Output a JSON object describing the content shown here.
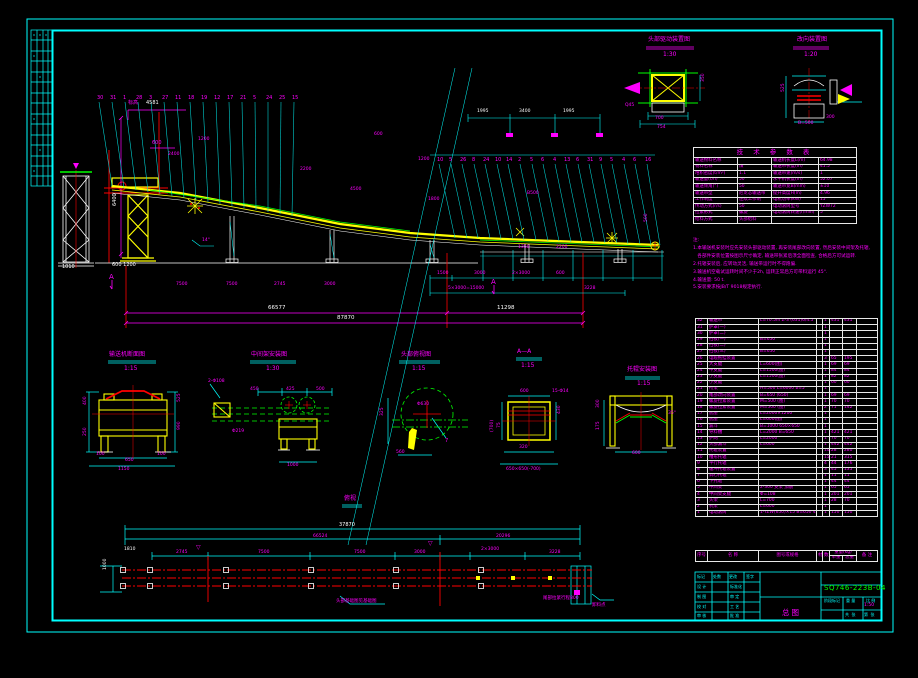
{
  "doc": {
    "drawing_no": "SQ746-223B-04",
    "view_title": "总图",
    "scale": "1:50"
  },
  "param_table": {
    "title": "技 术 参 数 表",
    "rows": [
      [
        "输送物料名称",
        "",
        "输送机长度L(m)",
        "64.98"
      ],
      [
        "物料名称",
        "煤",
        "输送带长度(m)",
        "41.5"
      ],
      [
        "堆积密度(t/m³)",
        "1.1",
        "输送带速(m/s)",
        "1"
      ],
      [
        "输送量(t/h)",
        "50",
        "水平机长度(m)",
        "52.07"
      ],
      [
        "输送倾角(°)",
        "50",
        "输送带宽B(mm)",
        "±10"
      ],
      [
        "输送带型",
        "尼龙芯输送带",
        "提升高度H(m)",
        "4.96"
      ],
      [
        "工作制度",
        "连续工作制",
        "电机功率(kW)",
        "15"
      ],
      [
        "传动方式(r/s)",
        "50",
        "电动滚筒型号",
        "YZW72"
      ],
      [
        "拉紧形式",
        "螺旋",
        "电动滚筒转速(r/min)",
        "5"
      ],
      [
        "给料方式",
        "头部给料",
        "",
        ""
      ]
    ]
  },
  "notes": [
    "注:",
    "1.本输送机安装时应先安装头部驱动装置, 再安装尾部改向装置, 然后安装中间架及托辊,",
    "   各部件安装位置按图示尺寸确定, 输送带张紧后须全面检查, 合格后方可试运转.",
    "2.托辊安装后, 应转动灵活, 输送带运行时不得跑偏.",
    "3.输送机空载试运转时间不少于2h, 运转正常后方可带料运行 45°.",
    "4.输送量: 50 t.",
    "5.安装要求按JB/T 9018规定执行."
  ],
  "bom": {
    "headers": {
      "no": "序号",
      "name": "名  称",
      "spec": "图号或规格",
      "mat": "材料",
      "qty": "数量",
      "weight": "重量(kg)",
      "unit": "单重",
      "total": "总重",
      "remark": "备 注"
    },
    "rows": [
      [
        "32",
        "输送带",
        "L=70.5m Z-3 (631)6/4.5",
        "",
        "1",
        "431",
        "431",
        ""
      ],
      [
        "31",
        "护罩(一)",
        "",
        "",
        "1",
        "",
        "",
        ""
      ],
      [
        "30",
        "护罩(二)",
        "",
        "",
        "1",
        "",
        "",
        ""
      ],
      [
        "29",
        "挡板(一)",
        "B=650",
        "",
        "1",
        "",
        "",
        ""
      ],
      [
        "28",
        "挡板(二)",
        "",
        "",
        "1",
        "",
        "",
        ""
      ],
      [
        "27",
        "挡板(三)",
        "B=650",
        "",
        "1",
        "",
        "",
        ""
      ],
      [
        "26",
        "电缆拖挂装置",
        "",
        "",
        "3",
        "65",
        "195",
        ""
      ],
      [
        "25",
        "大支腿",
        "L=600(图)",
        "",
        "1",
        "69",
        "69",
        ""
      ],
      [
        "24",
        "中支腿",
        "L=1500(图)",
        "",
        "1",
        "84",
        "84",
        ""
      ],
      [
        "23",
        "小支腿",
        "L=1500(图)",
        "",
        "1",
        "82",
        "82",
        ""
      ],
      [
        "22",
        "小支腿",
        "",
        "",
        "1",
        "60",
        "60",
        ""
      ],
      [
        "21",
        "桁架",
        "H=500 L=6000 b=5°",
        "",
        "1",
        "",
        "",
        ""
      ],
      [
        "20",
        "尾部改向装置",
        "B=650 (650)",
        "",
        "1",
        "69",
        "69",
        ""
      ],
      [
        "19",
        "螺旋拉紧装置",
        "M=500 (图)",
        "",
        "1",
        "70",
        "70",
        ""
      ],
      [
        "18",
        "螺旋拉紧装置",
        "M=500 (图)",
        "",
        "2",
        "71",
        "142",
        ""
      ],
      [
        "17",
        "底座",
        "L=2000×1200",
        "",
        "1",
        "",
        "",
        ""
      ],
      [
        "16",
        "底座",
        "L=600(图)",
        "",
        "1",
        "",
        "",
        ""
      ],
      [
        "15",
        "漏斗",
        "B=1000 650×650",
        "",
        "1",
        "",
        "",
        ""
      ],
      [
        "14",
        "导料槽",
        "L=2000 B=650",
        "",
        "1",
        "421",
        "421",
        ""
      ],
      [
        "13",
        "护网",
        "L=2000",
        "",
        "1",
        "70",
        "70",
        ""
      ],
      [
        "12",
        "头部漏斗",
        "L=600",
        "",
        "1",
        "442",
        "442",
        ""
      ],
      [
        "11",
        "托辊装置",
        "",
        "",
        "10",
        "28",
        "280",
        ""
      ],
      [
        "10",
        "槽形托辊",
        "",
        "",
        "15",
        "21",
        "315",
        ""
      ],
      [
        "9",
        "平行托辊",
        "",
        "",
        "4",
        "44",
        "176",
        ""
      ],
      [
        "8",
        "缓冲托辊装置",
        "",
        "",
        "3",
        "45",
        "135",
        ""
      ],
      [
        "7",
        "调心托辊",
        "",
        "",
        "1",
        "11",
        "11",
        ""
      ],
      [
        "6",
        "下托辊",
        "",
        "",
        "1",
        "44",
        "44",
        ""
      ],
      [
        "5",
        "中间架",
        "2-300 支架 加筋",
        "",
        "1",
        "65",
        "65",
        ""
      ],
      [
        "4",
        "中间架支腿",
        "Φ=108",
        "",
        "1",
        "201",
        "201",
        ""
      ],
      [
        "3",
        "头架",
        "L=700",
        "",
        "1",
        "28",
        "70",
        ""
      ],
      [
        "2",
        "机架",
        "L=600",
        "",
        "1",
        "",
        "",
        ""
      ],
      [
        "1",
        "电动滚筒",
        "1-YZW(650)×15 B=650 45r/min",
        "",
        "1",
        "150",
        "150",
        ""
      ]
    ]
  },
  "labels": [
    {
      "x": 648,
      "y": 37,
      "t": "头部驱动装置图",
      "s": 6
    },
    {
      "x": 663,
      "y": 52,
      "t": "1:30",
      "s": 6
    },
    {
      "x": 797,
      "y": 37,
      "t": "改向装置图",
      "s": 6
    },
    {
      "x": 804,
      "y": 52,
      "t": "1:20",
      "s": 6
    },
    {
      "x": 109,
      "y": 352,
      "t": "输送机断面图",
      "s": 6
    },
    {
      "x": 124,
      "y": 366,
      "t": "1:15",
      "s": 6
    },
    {
      "x": 251,
      "y": 352,
      "t": "中间架安装图",
      "s": 6
    },
    {
      "x": 266,
      "y": 366,
      "t": "1:30",
      "s": 6
    },
    {
      "x": 401,
      "y": 352,
      "t": "头部俯视图",
      "s": 6
    },
    {
      "x": 412,
      "y": 366,
      "t": "1:15",
      "s": 6
    },
    {
      "x": 517,
      "y": 349,
      "t": "A—A",
      "s": 6
    },
    {
      "x": 521,
      "y": 363,
      "t": "1:15",
      "s": 6
    },
    {
      "x": 627,
      "y": 367,
      "t": "托辊安装图",
      "s": 6
    },
    {
      "x": 637,
      "y": 381,
      "t": "1:15",
      "s": 6
    },
    {
      "x": 344,
      "y": 496,
      "t": "俯视",
      "s": 6
    },
    {
      "x": 268,
      "y": 306,
      "t": "66577",
      "c": "#fff",
      "s": 5.5
    },
    {
      "x": 497,
      "y": 306,
      "t": "11298",
      "c": "#fff",
      "s": 5.5
    },
    {
      "x": 337,
      "y": 316,
      "t": "87870",
      "c": "#fff",
      "s": 5.5
    },
    {
      "x": 128,
      "y": 101,
      "t": "标高"
    },
    {
      "x": 146,
      "y": 101,
      "t": "4581",
      "c": "#fff"
    },
    {
      "x": 113,
      "y": 206,
      "t": "6400",
      "c": "#fff",
      "r": -90
    },
    {
      "x": 112,
      "y": 263,
      "t": "600 1200",
      "c": "#fff"
    },
    {
      "x": 62,
      "y": 265,
      "t": "1010",
      "c": "#fff"
    },
    {
      "x": 152,
      "y": 141,
      "t": "600"
    },
    {
      "x": 109,
      "y": 274,
      "t": "A",
      "s": 7
    },
    {
      "x": 491,
      "y": 279,
      "t": "A",
      "s": 7
    },
    {
      "x": 477,
      "y": 110,
      "t": "1995",
      "c": "#fff",
      "s": 4.5
    },
    {
      "x": 519,
      "y": 110,
      "t": "3400",
      "c": "#fff",
      "s": 4.5
    },
    {
      "x": 563,
      "y": 110,
      "t": "1995",
      "c": "#fff",
      "s": 4.5
    },
    {
      "x": 176,
      "y": 283,
      "t": "7500",
      "s": 4.5
    },
    {
      "x": 226,
      "y": 283,
      "t": "7500",
      "s": 4.5
    },
    {
      "x": 274,
      "y": 283,
      "t": "2745",
      "s": 4.5
    },
    {
      "x": 324,
      "y": 283,
      "t": "3000",
      "s": 4.5
    },
    {
      "x": 437,
      "y": 272,
      "t": "1500",
      "s": 4.5
    },
    {
      "x": 474,
      "y": 272,
      "t": "3000",
      "s": 4.5
    },
    {
      "x": 512,
      "y": 272,
      "t": "2×3000",
      "s": 4.5
    },
    {
      "x": 556,
      "y": 272,
      "t": "600",
      "s": 4.5
    },
    {
      "x": 448,
      "y": 287,
      "t": "5×3000=15000",
      "s": 4.5
    },
    {
      "x": 584,
      "y": 287,
      "t": "3228",
      "s": 4.5
    },
    {
      "x": 518,
      "y": 246,
      "t": "1350",
      "s": 4.5
    },
    {
      "x": 556,
      "y": 246,
      "t": "2200",
      "s": 4.5
    },
    {
      "x": 350,
      "y": 188,
      "t": "4500",
      "s": 4.5
    },
    {
      "x": 300,
      "y": 168,
      "t": "2200",
      "s": 4.5
    },
    {
      "x": 428,
      "y": 198,
      "t": "1800",
      "s": 4.5
    },
    {
      "x": 527,
      "y": 192,
      "t": "B500",
      "s": 4.5
    },
    {
      "x": 374,
      "y": 133,
      "t": "600",
      "s": 4.5
    },
    {
      "x": 418,
      "y": 158,
      "t": "1200",
      "s": 4.5
    },
    {
      "x": 168,
      "y": 153,
      "t": "2400",
      "s": 4.5
    },
    {
      "x": 198,
      "y": 138,
      "t": "1200",
      "s": 4.5
    },
    {
      "x": 202,
      "y": 239,
      "t": "14°",
      "s": 4.5
    },
    {
      "x": 645,
      "y": 222,
      "t": "500",
      "s": 4.5,
      "r": -90
    },
    {
      "x": 339,
      "y": 523,
      "t": "37870",
      "c": "#fff",
      "s": 5
    },
    {
      "x": 313,
      "y": 535,
      "t": "66524",
      "s": 4.5
    },
    {
      "x": 496,
      "y": 535,
      "t": "20296",
      "s": 4.5
    },
    {
      "x": 124,
      "y": 548,
      "t": "1810",
      "c": "#fff",
      "s": 4.5
    },
    {
      "x": 104,
      "y": 570,
      "t": "1000",
      "c": "#fff",
      "s": 4.5,
      "r": -90
    },
    {
      "x": 176,
      "y": 551,
      "t": "2745",
      "s": 4.5
    },
    {
      "x": 258,
      "y": 551,
      "t": "7500",
      "s": 4.5
    },
    {
      "x": 354,
      "y": 551,
      "t": "7500",
      "s": 4.5
    },
    {
      "x": 414,
      "y": 551,
      "t": "3000",
      "s": 4.5
    },
    {
      "x": 481,
      "y": 548,
      "t": "2×3000",
      "s": 4.5
    },
    {
      "x": 549,
      "y": 551,
      "t": "3228",
      "s": 4.5
    },
    {
      "x": 196,
      "y": 545,
      "t": "▽",
      "s": 6
    },
    {
      "x": 428,
      "y": 541,
      "t": "▽",
      "s": 6
    },
    {
      "x": 336,
      "y": 600,
      "t": "头部基础图见基础图",
      "s": 4.5
    },
    {
      "x": 543,
      "y": 597,
      "t": "尾部拉紧行程800",
      "s": 4.5
    },
    {
      "x": 592,
      "y": 604,
      "t": "卸料点",
      "s": 4.5
    },
    {
      "x": 125,
      "y": 459,
      "t": "650",
      "s": 4.5
    },
    {
      "x": 118,
      "y": 468,
      "t": "1150",
      "s": 4.5
    },
    {
      "x": 84,
      "y": 405,
      "t": "400",
      "s": 4.5,
      "r": -90
    },
    {
      "x": 84,
      "y": 436,
      "t": "250",
      "s": 4.5,
      "r": -90
    },
    {
      "x": 178,
      "y": 402,
      "t": "525",
      "s": 4.5,
      "r": -90
    },
    {
      "x": 178,
      "y": 430,
      "t": "990",
      "s": 4.5,
      "r": -90
    },
    {
      "x": 96,
      "y": 453,
      "t": "100",
      "s": 4.5
    },
    {
      "x": 157,
      "y": 453,
      "t": "100",
      "s": 4.5
    },
    {
      "x": 250,
      "y": 388,
      "t": "450",
      "s": 4.5
    },
    {
      "x": 286,
      "y": 388,
      "t": "425",
      "s": 4.5
    },
    {
      "x": 316,
      "y": 388,
      "t": "500",
      "s": 4.5
    },
    {
      "x": 287,
      "y": 464,
      "t": "1000",
      "s": 4.5
    },
    {
      "x": 232,
      "y": 430,
      "t": "Φ219",
      "s": 4.5
    },
    {
      "x": 208,
      "y": 380,
      "t": "2-Φ108",
      "s": 4.5
    },
    {
      "x": 417,
      "y": 403,
      "t": "Φ630",
      "s": 4.5
    },
    {
      "x": 396,
      "y": 451,
      "t": "560",
      "s": 4.5
    },
    {
      "x": 381,
      "y": 416,
      "t": "325",
      "s": 4.5,
      "r": -90
    },
    {
      "x": 445,
      "y": 439,
      "t": "7",
      "s": 5
    },
    {
      "x": 520,
      "y": 390,
      "t": "600",
      "s": 4.5
    },
    {
      "x": 552,
      "y": 390,
      "t": "15-Φ14",
      "s": 4.5
    },
    {
      "x": 558,
      "y": 414,
      "t": "430",
      "s": 4.5,
      "r": -90
    },
    {
      "x": 498,
      "y": 428,
      "t": "75",
      "s": 4.5,
      "r": -90
    },
    {
      "x": 519,
      "y": 446,
      "t": "320",
      "s": 4.5
    },
    {
      "x": 506,
      "y": 468,
      "t": "650×650(-700)",
      "s": 4.5
    },
    {
      "x": 491,
      "y": 432,
      "t": "(700)",
      "s": 4.5,
      "r": -90
    },
    {
      "x": 632,
      "y": 452,
      "t": "600",
      "s": 4.5
    },
    {
      "x": 597,
      "y": 408,
      "t": "300",
      "s": 4.5,
      "r": -90
    },
    {
      "x": 597,
      "y": 430,
      "t": "175",
      "s": 4.5,
      "r": -90
    },
    {
      "x": 668,
      "y": 412,
      "t": "35°",
      "s": 4.5
    },
    {
      "x": 655,
      "y": 117,
      "t": "700",
      "s": 4.5
    },
    {
      "x": 657,
      "y": 126,
      "t": "754",
      "s": 4.5
    },
    {
      "x": 625,
      "y": 104,
      "t": "Q45",
      "s": 4.5
    },
    {
      "x": 702,
      "y": 82,
      "t": "350",
      "s": 4.5,
      "r": -90
    },
    {
      "x": 782,
      "y": 92,
      "t": "525",
      "s": 4.5,
      "r": -90
    },
    {
      "x": 798,
      "y": 122,
      "t": "B=500",
      "s": 4.5
    },
    {
      "x": 826,
      "y": 116,
      "t": "300",
      "s": 4.5
    },
    {
      "x": 697,
      "y": 575,
      "t": "标记",
      "c": "#00ffff",
      "s": 4
    },
    {
      "x": 713,
      "y": 575,
      "t": "处数",
      "c": "#00ffff",
      "s": 4
    },
    {
      "x": 729,
      "y": 575,
      "t": "更改",
      "c": "#00ffff",
      "s": 4
    },
    {
      "x": 746,
      "y": 575,
      "t": "签字",
      "c": "#00ffff",
      "s": 4
    },
    {
      "x": 697,
      "y": 585,
      "t": "设 计",
      "c": "#00ffff",
      "s": 4
    },
    {
      "x": 697,
      "y": 595,
      "t": "制 图",
      "c": "#00ffff",
      "s": 4
    },
    {
      "x": 697,
      "y": 605,
      "t": "校 对",
      "c": "#00ffff",
      "s": 4
    },
    {
      "x": 697,
      "y": 614,
      "t": "审 核",
      "c": "#00ffff",
      "s": 4
    },
    {
      "x": 730,
      "y": 585,
      "t": "标准化",
      "c": "#00ffff",
      "s": 4
    },
    {
      "x": 730,
      "y": 595,
      "t": "审 定",
      "c": "#00ffff",
      "s": 4
    },
    {
      "x": 730,
      "y": 605,
      "t": "工 艺",
      "c": "#00ffff",
      "s": 4
    },
    {
      "x": 730,
      "y": 614,
      "t": "批 准",
      "c": "#00ffff",
      "s": 4
    },
    {
      "x": 824,
      "y": 599,
      "t": "阶段标记",
      "c": "#00ffff",
      "s": 4
    },
    {
      "x": 846,
      "y": 599,
      "t": "重 量",
      "c": "#00ffff",
      "s": 4
    },
    {
      "x": 866,
      "y": 599,
      "t": "比 例",
      "c": "#00ffff",
      "s": 4
    },
    {
      "x": 845,
      "y": 613,
      "t": "共  张",
      "c": "#00ffff",
      "s": 4
    },
    {
      "x": 864,
      "y": 613,
      "t": "第  张",
      "c": "#00ffff",
      "s": 4
    }
  ],
  "balloons": [
    {
      "x": 97,
      "y": 96,
      "t": "30",
      "bx": 112,
      "by": 186
    },
    {
      "x": 110,
      "y": 96,
      "t": "31",
      "bx": 124,
      "by": 188
    },
    {
      "x": 123,
      "y": 96,
      "t": "1",
      "bx": 136,
      "by": 190
    },
    {
      "x": 136,
      "y": 96,
      "t": "28",
      "bx": 148,
      "by": 192
    },
    {
      "x": 149,
      "y": 96,
      "t": "3",
      "bx": 160,
      "by": 194
    },
    {
      "x": 162,
      "y": 96,
      "t": "27",
      "bx": 172,
      "by": 196
    },
    {
      "x": 175,
      "y": 96,
      "t": "11",
      "bx": 184,
      "by": 198
    },
    {
      "x": 188,
      "y": 96,
      "t": "18",
      "bx": 196,
      "by": 200
    },
    {
      "x": 201,
      "y": 96,
      "t": "19",
      "bx": 208,
      "by": 202
    },
    {
      "x": 214,
      "y": 96,
      "t": "12",
      "bx": 220,
      "by": 204
    },
    {
      "x": 227,
      "y": 96,
      "t": "17",
      "bx": 232,
      "by": 206
    },
    {
      "x": 240,
      "y": 96,
      "t": "21",
      "bx": 244,
      "by": 208
    },
    {
      "x": 253,
      "y": 96,
      "t": "5",
      "bx": 256,
      "by": 210
    },
    {
      "x": 266,
      "y": 96,
      "t": "24",
      "bx": 268,
      "by": 212
    },
    {
      "x": 279,
      "y": 96,
      "t": "25",
      "bx": 280,
      "by": 214
    },
    {
      "x": 292,
      "y": 96,
      "t": "15",
      "bx": 292,
      "by": 216
    },
    {
      "x": 437,
      "y": 158,
      "t": "10",
      "bx": 455,
      "by": 238
    },
    {
      "x": 449,
      "y": 158,
      "t": "5",
      "bx": 467,
      "by": 238
    },
    {
      "x": 460,
      "y": 158,
      "t": "26",
      "bx": 478,
      "by": 238
    },
    {
      "x": 472,
      "y": 158,
      "t": "8",
      "bx": 490,
      "by": 238
    },
    {
      "x": 483,
      "y": 158,
      "t": "24",
      "bx": 501,
      "by": 239
    },
    {
      "x": 495,
      "y": 158,
      "t": "10",
      "bx": 513,
      "by": 239
    },
    {
      "x": 506,
      "y": 158,
      "t": "14",
      "bx": 524,
      "by": 240
    },
    {
      "x": 518,
      "y": 158,
      "t": "2",
      "bx": 536,
      "by": 240
    },
    {
      "x": 530,
      "y": 158,
      "t": "5",
      "bx": 548,
      "by": 241
    },
    {
      "x": 541,
      "y": 158,
      "t": "6",
      "bx": 559,
      "by": 241
    },
    {
      "x": 553,
      "y": 158,
      "t": "4",
      "bx": 571,
      "by": 242
    },
    {
      "x": 564,
      "y": 158,
      "t": "13",
      "bx": 582,
      "by": 242
    },
    {
      "x": 576,
      "y": 158,
      "t": "6",
      "bx": 594,
      "by": 242
    },
    {
      "x": 587,
      "y": 158,
      "t": "31",
      "bx": 605,
      "by": 243
    },
    {
      "x": 599,
      "y": 158,
      "t": "9",
      "bx": 617,
      "by": 243
    },
    {
      "x": 610,
      "y": 158,
      "t": "5",
      "bx": 628,
      "by": 244
    },
    {
      "x": 622,
      "y": 158,
      "t": "4",
      "bx": 640,
      "by": 244
    },
    {
      "x": 633,
      "y": 158,
      "t": "6",
      "bx": 651,
      "by": 245
    },
    {
      "x": 645,
      "y": 158,
      "t": "16",
      "bx": 660,
      "by": 245
    }
  ]
}
